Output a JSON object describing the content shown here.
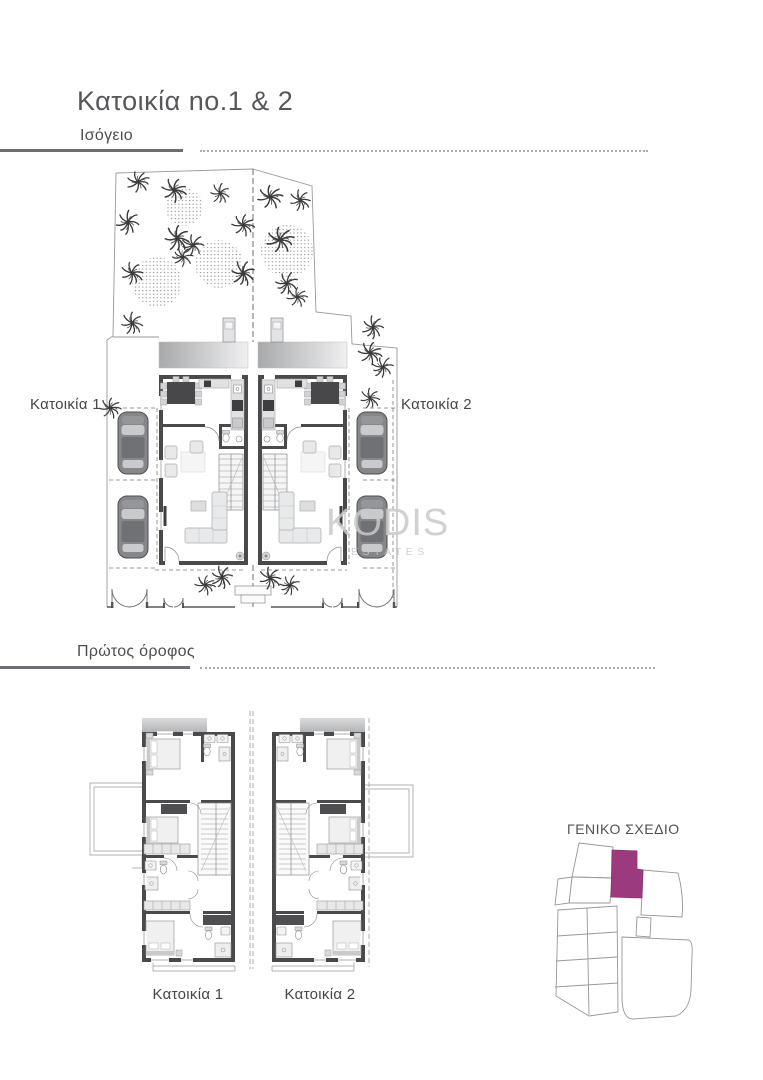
{
  "page": {
    "title": "Κατοικία no.1 & 2"
  },
  "ground_floor": {
    "heading": "Ισόγειο",
    "label_house1": "Κατοικία 1",
    "label_house2": "Κατοικία 2"
  },
  "first_floor": {
    "heading": "Πρώτος όροφος",
    "label_house1": "Κατοικία 1",
    "label_house2": "Κατοικία 2"
  },
  "site_overview": {
    "heading": "ΓΕΝΙΚΟ ΣΧΕΔΙΟ",
    "highlighted_plot_color": "#9C3A7E"
  },
  "watermark": {
    "brand": "KODIS",
    "sub": "ESTATES"
  },
  "colors": {
    "heading_text": "#56575A",
    "rule": "#6D6E71",
    "plan_walls": "#4A4A4C",
    "accent_plot": "#9C3A7E",
    "watermark": "#C9C9CB"
  }
}
